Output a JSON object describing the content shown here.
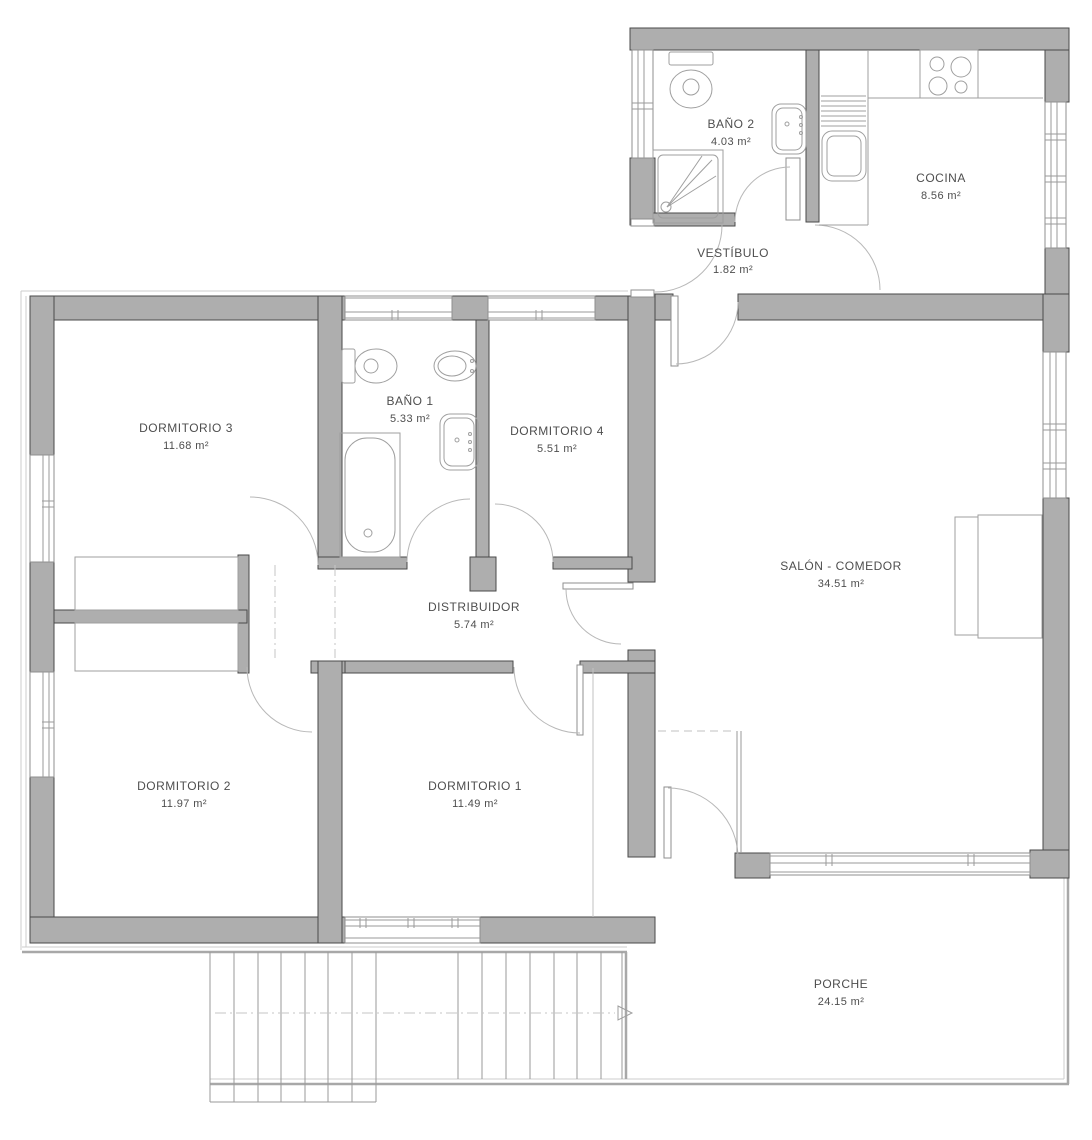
{
  "plan": {
    "type": "floor-plan",
    "units": "m²"
  },
  "rooms": [
    {
      "id": "banyo2",
      "name": "BAÑO 2",
      "area": "4.03 m²"
    },
    {
      "id": "cocina",
      "name": "COCINA",
      "area": "8.56 m²"
    },
    {
      "id": "vestibulo",
      "name": "VESTÍBULO",
      "area": "1.82 m²"
    },
    {
      "id": "dormitorio3",
      "name": "DORMITORIO 3",
      "area": "11.68 m²"
    },
    {
      "id": "banyo1",
      "name": "BAÑO 1",
      "area": "5.33 m²"
    },
    {
      "id": "dormitorio4",
      "name": "DORMITORIO 4",
      "area": "5.51 m²"
    },
    {
      "id": "salon",
      "name": "SALÓN - COMEDOR",
      "area": "34.51 m²"
    },
    {
      "id": "distribuidor",
      "name": "DISTRIBUIDOR",
      "area": "5.74 m²"
    },
    {
      "id": "dormitorio2",
      "name": "DORMITORIO 2",
      "area": "11.97 m²"
    },
    {
      "id": "dormitorio1",
      "name": "DORMITORIO 1",
      "area": "11.49 m²"
    },
    {
      "id": "porche",
      "name": "PORCHE",
      "area": "24.15 m²"
    }
  ],
  "colors": {
    "wall_fill": "#aeaeae",
    "wall_stroke": "#4a4a4a",
    "line_gray": "#9a9a9a",
    "text_color": "#4e4e4e",
    "background": "#ffffff"
  },
  "icons": [
    "toilet-icon",
    "shower-icon",
    "washbasin-icon",
    "bidet-icon",
    "bathtub-icon",
    "stove-icon",
    "kitchen-sink-icon",
    "sofa-icon",
    "wardrobe-icon",
    "stairs",
    "direction-arrow-icon",
    "door-arc",
    "window"
  ]
}
